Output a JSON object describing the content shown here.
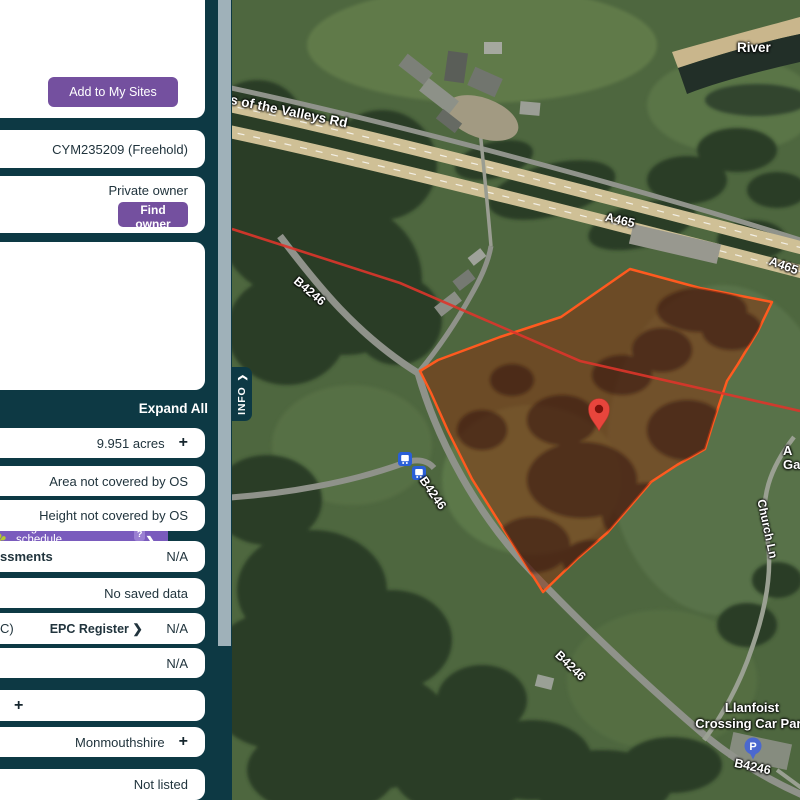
{
  "colors": {
    "sidebar_bg": "#0d3944",
    "accent_purple": "#74509f",
    "register_purple": "#7a5bbd",
    "parcel_stroke": "#ff5a1f",
    "parcel_fill": "#8a2f0e",
    "pin_red": "#e8453c",
    "transit_blue": "#2a5fd7"
  },
  "sidebar": {
    "add_button": "Add to My Sites",
    "title_number": "CYM235209 (Freehold)",
    "owner_type": "Private owner",
    "find_owner_button": "Find owner",
    "register": {
      "icon": "✽",
      "label": "Register & lease schedule",
      "help_badge": "?",
      "price": "£3.00",
      "chevron": "❯"
    },
    "expand_all": "Expand All",
    "rows": [
      {
        "right": "9.951 acres",
        "plus": "+"
      },
      {
        "right": "Area not covered by OS"
      },
      {
        "right": "Height not covered by OS"
      },
      {
        "left": "ssments",
        "right": "N/A"
      },
      {
        "right": "No saved data"
      },
      {
        "left": "C)",
        "mid": "EPC Register ❯",
        "right": "N/A"
      },
      {
        "right": "N/A"
      },
      {
        "plus": "+"
      },
      {
        "right": "Monmouthshire",
        "plus": "+"
      },
      {
        "right": "Not listed"
      }
    ]
  },
  "info_tab": {
    "label": "INFO",
    "chevron": "❯"
  },
  "map": {
    "labels": {
      "river": "River",
      "valleys_rd": "s of the Valleys Rd",
      "a465_1": "A465",
      "a465_2": "A465",
      "b4246_1": "B4246",
      "b4246_2": "B4246",
      "b4246_3": "B4246",
      "b4246_4": "B4246",
      "church_ln": "Church Ln",
      "llanfoist_1": "Llanfoist",
      "llanfoist_2": "Crossing Car Park",
      "cut_1": "A",
      "cut_2": "Ga",
      "parking": "P"
    }
  }
}
